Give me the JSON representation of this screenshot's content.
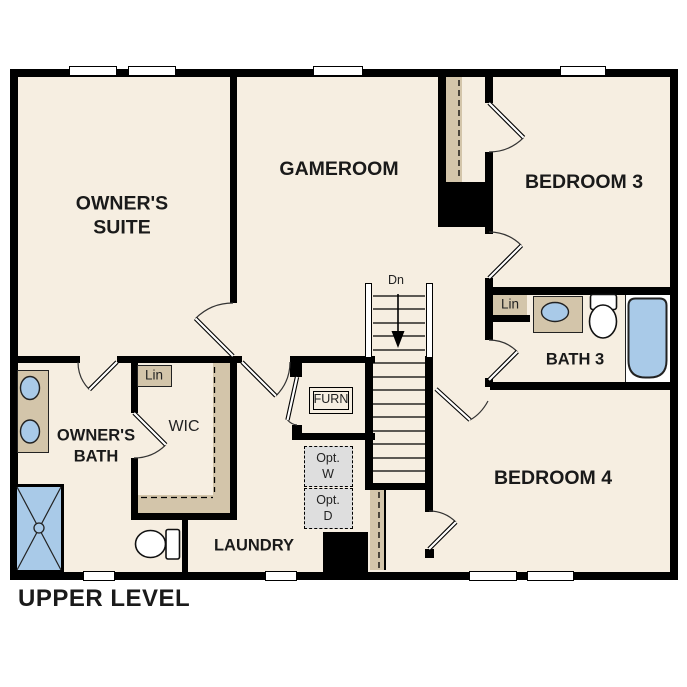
{
  "title": "UPPER LEVEL",
  "colors": {
    "floor": "#f6eee1",
    "tan": "#d3c5aa",
    "blue": "#a9cae8",
    "graybox": "#dedede",
    "wall": "#000000",
    "ink": "#1a1a1a"
  },
  "rooms": {
    "owners_suite": {
      "line1": "OWNER'S",
      "line2": "SUITE"
    },
    "gameroom": {
      "label": "GAMEROOM"
    },
    "bedroom3": {
      "label": "BEDROOM 3"
    },
    "owners_bath": {
      "line1": "OWNER'S",
      "line2": "BATH"
    },
    "wic": {
      "label": "WIC"
    },
    "laundry": {
      "label": "LAUNDRY"
    },
    "bath3": {
      "label": "BATH 3"
    },
    "bedroom4": {
      "label": "BEDROOM 4"
    }
  },
  "annotations": {
    "lin_wic": "Lin",
    "lin_bath3": "Lin",
    "furnace": "FURN",
    "opt_washer": {
      "line1": "Opt.",
      "line2": "W"
    },
    "opt_dryer": {
      "line1": "Opt.",
      "line2": "D"
    },
    "stairs_down": "Dn"
  },
  "fixtures": [
    "double-vanity-sinks",
    "walk-in-shower",
    "owner-toilet",
    "wic-shelving-rod",
    "staircase-down",
    "bath3-vanity-sink",
    "bath3-toilet",
    "soaking-tub",
    "optional-washer",
    "optional-dryer",
    "furnace-closet",
    "linen-closets",
    "windows"
  ]
}
